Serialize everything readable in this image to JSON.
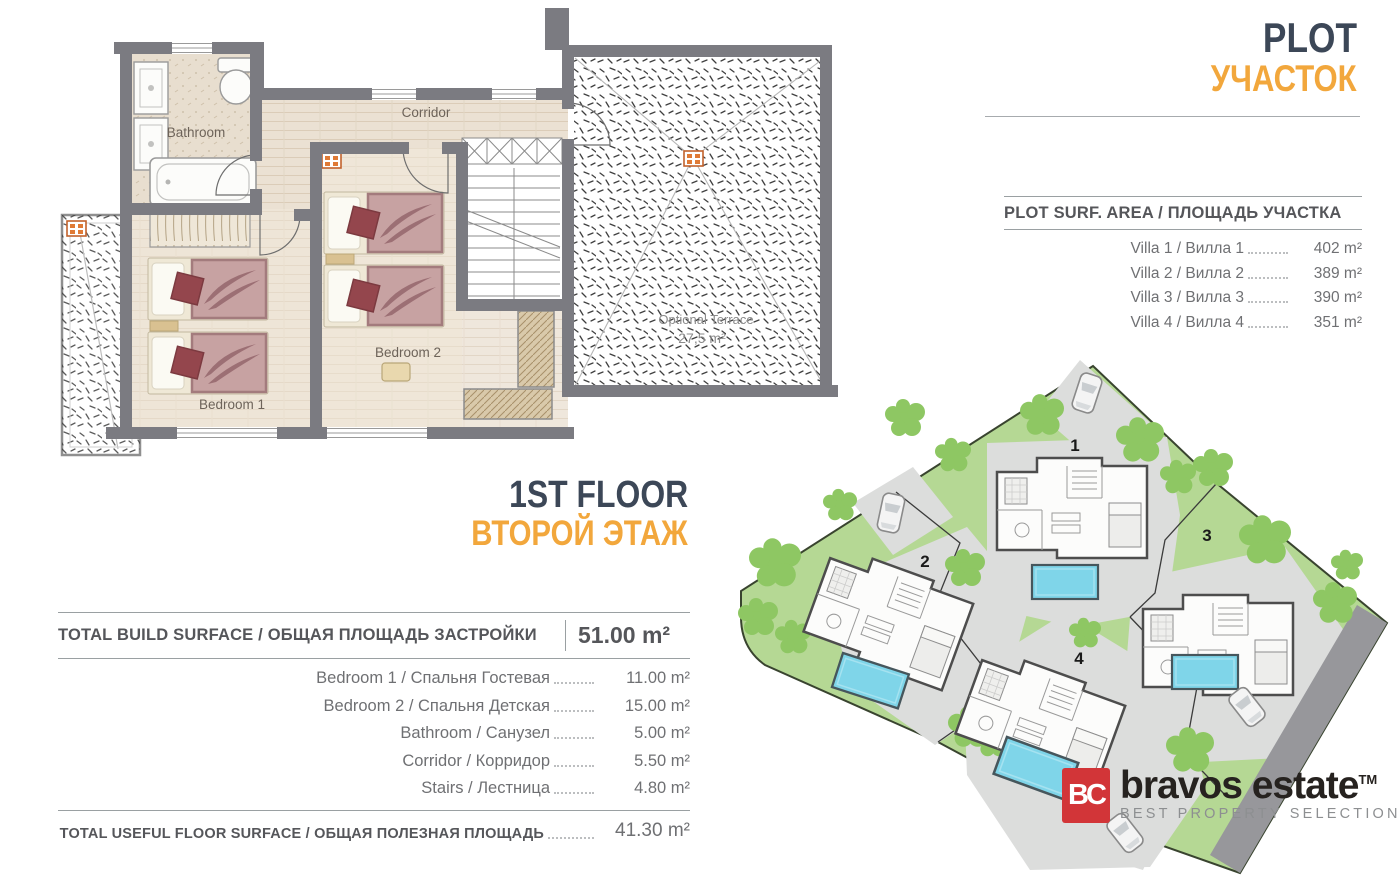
{
  "floor_plan": {
    "labels": {
      "bathroom": "Bathroom",
      "corridor": "Corridor",
      "bedroom1": "Bedroom 1",
      "bedroom2": "Bedroom 2",
      "terrace": "Optional Terrace",
      "terrace_area": "27,5 m²"
    }
  },
  "floor_title": {
    "en": "1ST FLOOR",
    "ru": "ВТОРОЙ ЭТАЖ"
  },
  "build_table": {
    "header_label": "TOTAL BUILD SURFACE / ОБЩАЯ ПЛОЩАДЬ ЗАСТРОЙКИ",
    "header_value": "51.00 m²",
    "rows": [
      {
        "label": "Bedroom 1 / Спальня Гостевая",
        "value": "11.00 m²"
      },
      {
        "label": "Bedroom 2 / Спальня Детская",
        "value": "15.00 m²"
      },
      {
        "label": "Bathroom / Санузел",
        "value": "5.00 m²"
      },
      {
        "label": "Corridor / Корридор",
        "value": "5.50 m²"
      },
      {
        "label": "Stairs / Лестница",
        "value": "4.80 m²"
      }
    ],
    "footer_label": "TOTAL USEFUL FLOOR SURFACE / ОБЩАЯ ПОЛЕЗНАЯ ПЛОЩАДЬ",
    "footer_value": "41.30 m²"
  },
  "plot_panel": {
    "title_en": "PLOT",
    "title_ru": "УЧАСТОК",
    "table_header": "PLOT SURF. AREA / ПЛОЩАДЬ УЧАСТКА",
    "rows": [
      {
        "label": "Villa 1 / Вилла 1",
        "value": "402 m²"
      },
      {
        "label": "Villa 2 / Вилла 2",
        "value": "389 m²"
      },
      {
        "label": "Villa 3 / Вилла 3",
        "value": "390 m²"
      },
      {
        "label": "Villa 4 / Вилла 4",
        "value": "351 m²"
      }
    ]
  },
  "site_map": {
    "villa_numbers": [
      "1",
      "2",
      "3",
      "4"
    ]
  },
  "logo": {
    "monogram": "BC",
    "name": "bravos estate",
    "tm": "TM",
    "tagline": "BEST PROPERTY SELECTION"
  },
  "colors": {
    "title_dark": "#3c4757",
    "accent_orange": "#f2a73c",
    "logo_red": "#d23538",
    "wall_gray": "#7b7b81",
    "lawn_green": "#b5d894",
    "tree_green": "#8ec763",
    "pool_blue": "#7fd5e9",
    "patio_gray": "#dcdddc"
  }
}
